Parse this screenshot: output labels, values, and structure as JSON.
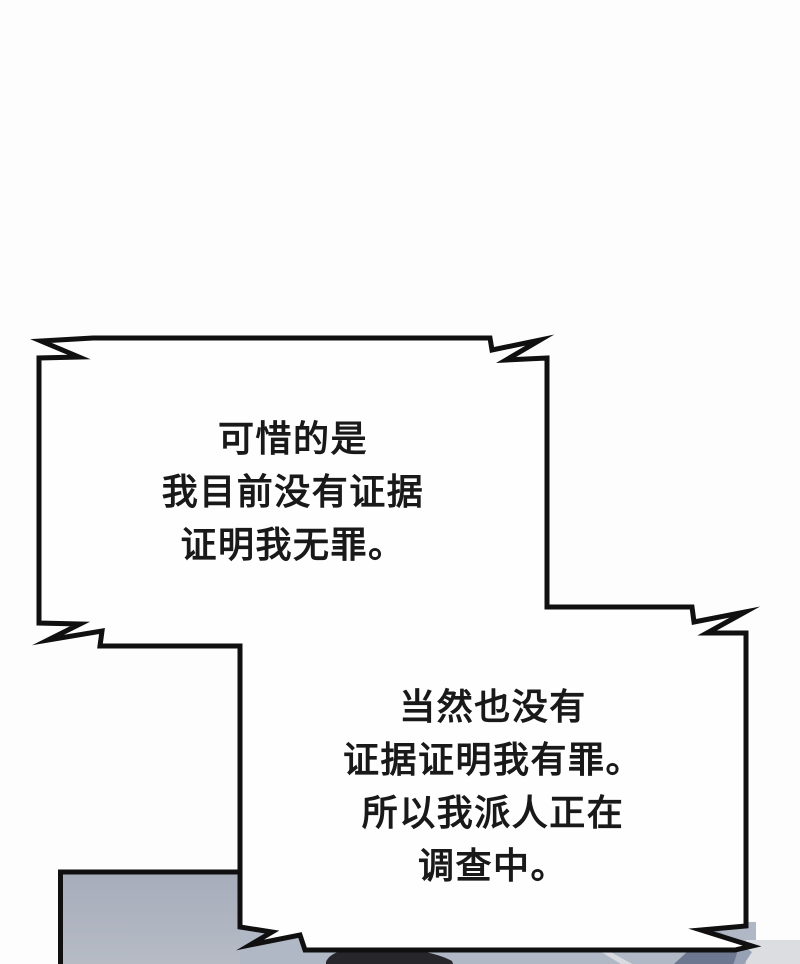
{
  "page": {
    "type": "comic-panel",
    "background": "#fdfdfd"
  },
  "bubbles": [
    {
      "name": "speech-bubble-top",
      "style": "jagged-rectangle",
      "lines": [
        "可惜的是",
        "我目前没有证据",
        "证明我无罪。"
      ]
    },
    {
      "name": "speech-bubble-bottom",
      "style": "jagged-rectangle",
      "lines": [
        "当然也没有",
        "证据证明我有罪。",
        "所以我派人正在",
        "调查中。"
      ]
    }
  ],
  "colors": {
    "page_bg": "#fdfdfd",
    "ink": "#101010",
    "text": "#191919",
    "bubble_fill": "#fefefe",
    "panel_top": "#a6acba",
    "panel_bottom": "#b8bdc6",
    "strip": "#b0b8c6",
    "streak_medium": "#97a1b5",
    "streak_dark": "#6d7890",
    "corner_light": "#dbdde0",
    "diag_light": "#d8dadf",
    "hair": "#26262b"
  }
}
